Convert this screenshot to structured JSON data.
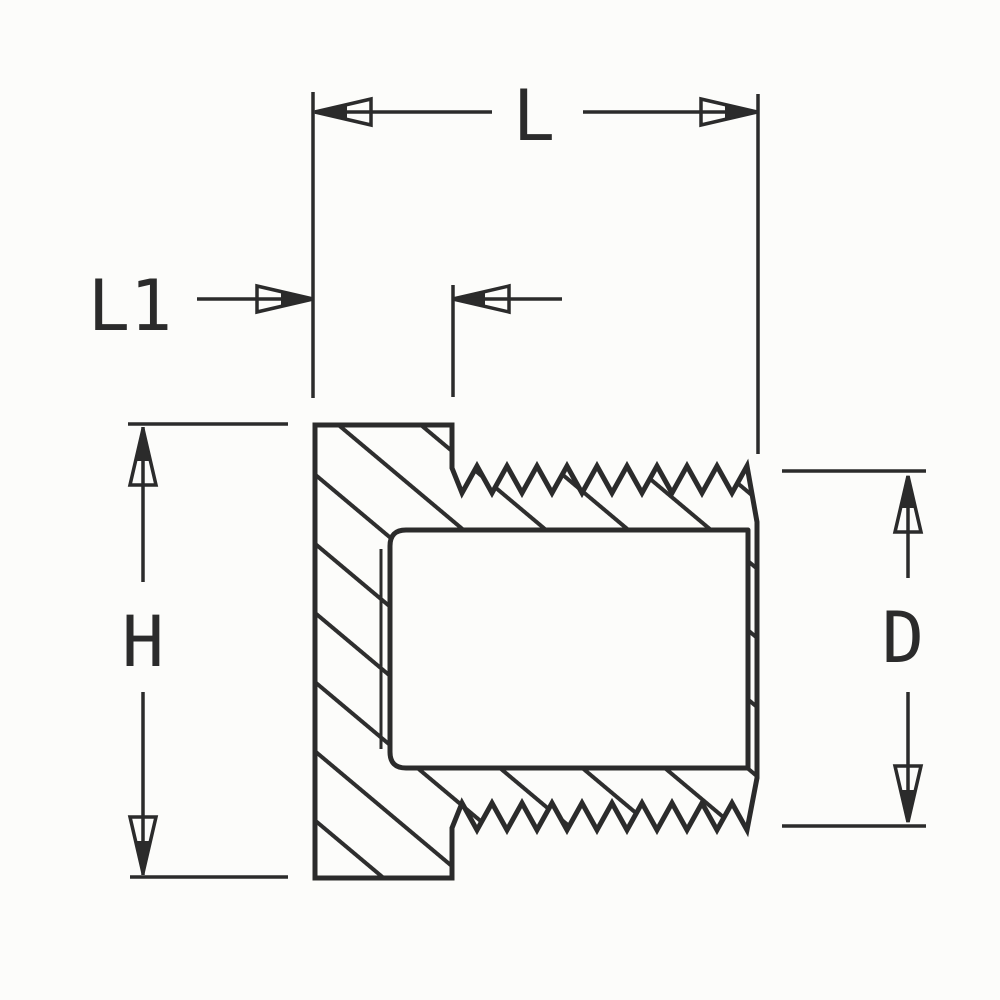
{
  "drawing": {
    "kind": "threaded-plug-cross-section",
    "paper_color": "#fcfcfa",
    "ink_color": "#2b2b2b",
    "labels": {
      "overall_length": "L",
      "head_length": "L1",
      "head_height": "H",
      "thread_diameter": "D"
    }
  }
}
